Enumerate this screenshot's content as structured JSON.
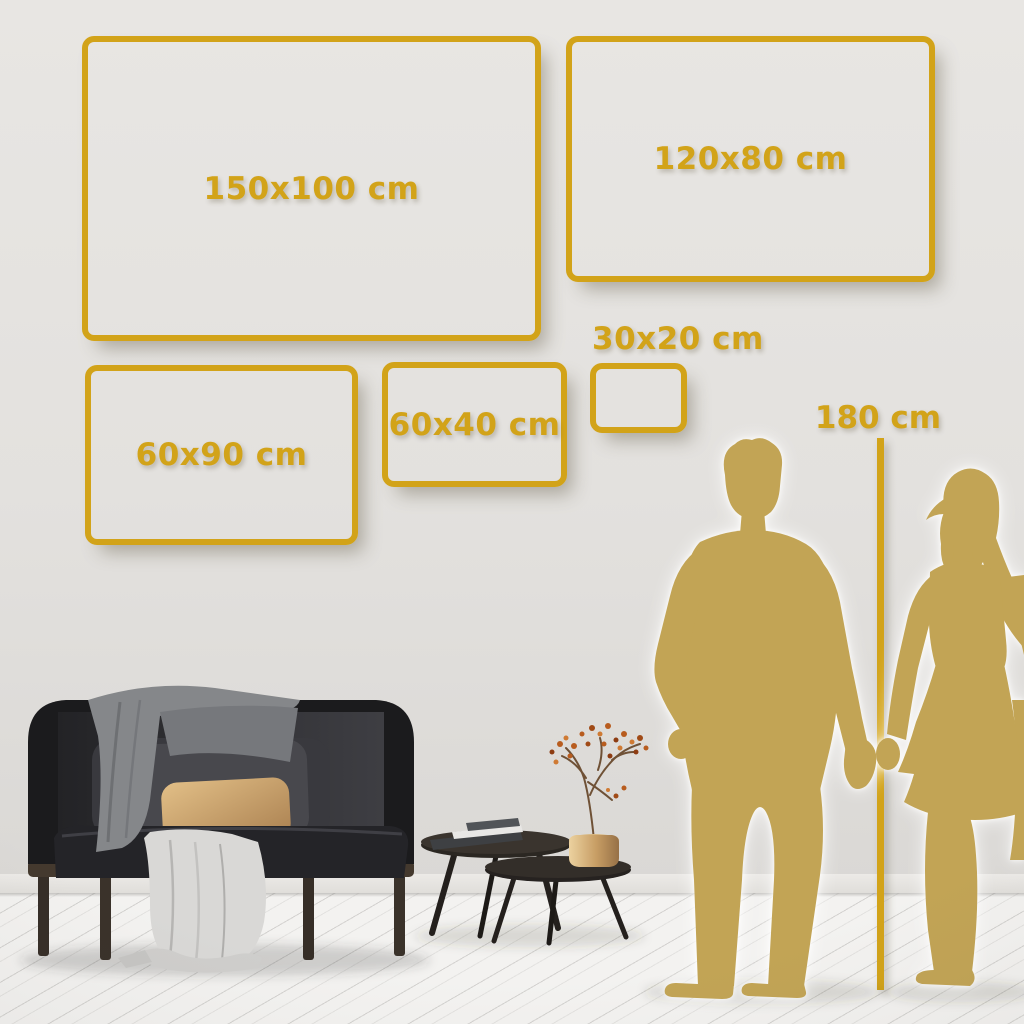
{
  "colors": {
    "gold_accent": "#D2A319",
    "gold_silhouette": "#C2A455",
    "wall": "#E3E1DE",
    "floor": "#F3F2F0"
  },
  "frames": [
    {
      "label": "150x100 cm",
      "width_cm": 150,
      "height_cm": 100
    },
    {
      "label": "120x80 cm",
      "width_cm": 120,
      "height_cm": 80
    },
    {
      "label": "60x90 cm",
      "width_cm": 60,
      "height_cm": 90
    },
    {
      "label": "60x40 cm",
      "width_cm": 60,
      "height_cm": 40
    },
    {
      "label": "30x20 cm",
      "width_cm": 30,
      "height_cm": 20
    }
  ],
  "ruler": {
    "label": "180 cm",
    "height_cm": 180
  }
}
